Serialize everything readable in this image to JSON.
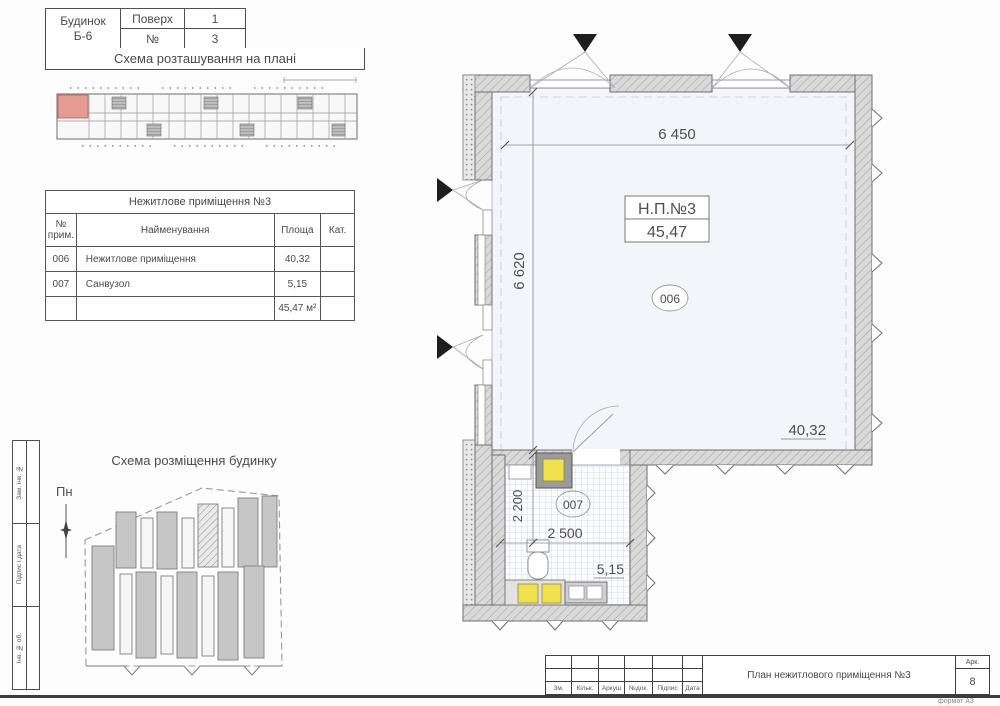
{
  "header": {
    "building_label": "Будинок",
    "building_value": "Б-6",
    "floor_label": "Поверх",
    "floor_value": "1",
    "no_label": "№",
    "no_value": "3"
  },
  "location_scheme": {
    "title": "Схема розташування на плані"
  },
  "room_table": {
    "title": "Нежитлове приміщення №3",
    "columns": {
      "num_l1": "№",
      "num_l2": "прим.",
      "name": "Найменування",
      "area": "Площа",
      "cat": "Кат."
    },
    "rows": [
      {
        "num": "006",
        "name": "Нежитлове приміщення",
        "area": "40,32",
        "cat": ""
      },
      {
        "num": "007",
        "name": "Санвузол",
        "area": "5,15",
        "cat": ""
      }
    ],
    "total": "45,47 м²"
  },
  "site_scheme": {
    "title": "Схема розміщення будинку",
    "north": "Пн"
  },
  "side_stamp": {
    "cell1": "Зам. інв. №",
    "cell2": "Підпис і дата",
    "cell3": "Інв. № об."
  },
  "plan": {
    "unit_label": "Н.П.№3",
    "unit_area": "45,47",
    "dim_top": "6 450",
    "dim_left": "6 620",
    "dim_bath_v": "2 200",
    "dim_bath_h": "2 500",
    "main_no": "006",
    "main_area": "40,32",
    "bath_no": "007",
    "bath_area": "5,15"
  },
  "title_block": {
    "doc_title": "План нежитлового приміщення №3",
    "labels": [
      "Зм.",
      "Кільк.",
      "Аркуш",
      "№док.",
      "Підпис",
      "Дата"
    ],
    "sheet_label": "Арк.",
    "sheet_no": "8",
    "format_note": "формат А3"
  },
  "colors": {
    "highlight": "#e59a92",
    "fixture_yellow": "#f1e04e",
    "room_fill": "#f3f5fa"
  }
}
